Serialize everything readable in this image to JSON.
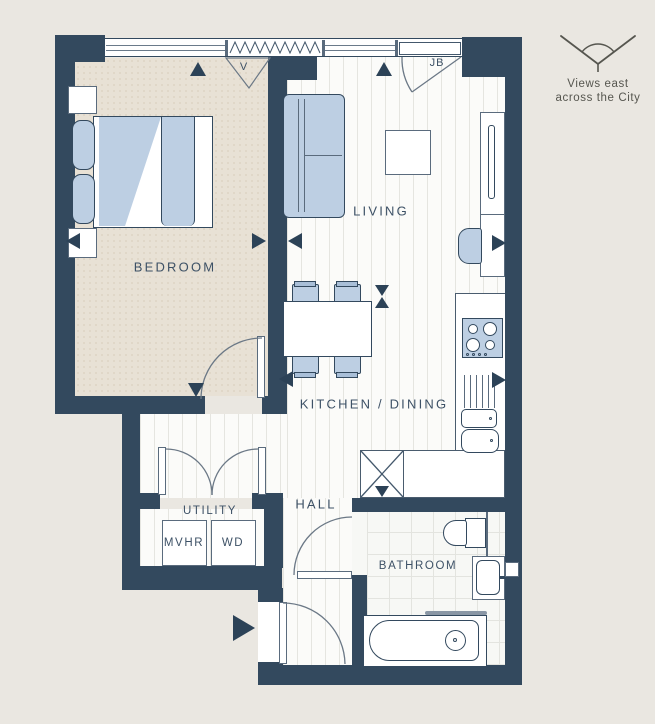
{
  "colors": {
    "wall": "#33495e",
    "furniture_blue": "#bdcfe3",
    "background": "#eae7e1",
    "label_text": "#3d5166",
    "note_text": "#56564f"
  },
  "rooms": {
    "bedroom": "BEDROOM",
    "living": "LIVING",
    "kitchen_dining": "KITCHEN / DINING",
    "hall": "HALL",
    "utility": "UTILITY",
    "bathroom": "BATHROOM"
  },
  "appliances": {
    "mvhr": "MVHR",
    "wd": "WD"
  },
  "annotations": {
    "vent": "V",
    "juliet_balcony": "JB",
    "view_note_line1": "Views east",
    "view_note_line2": "across the City"
  }
}
